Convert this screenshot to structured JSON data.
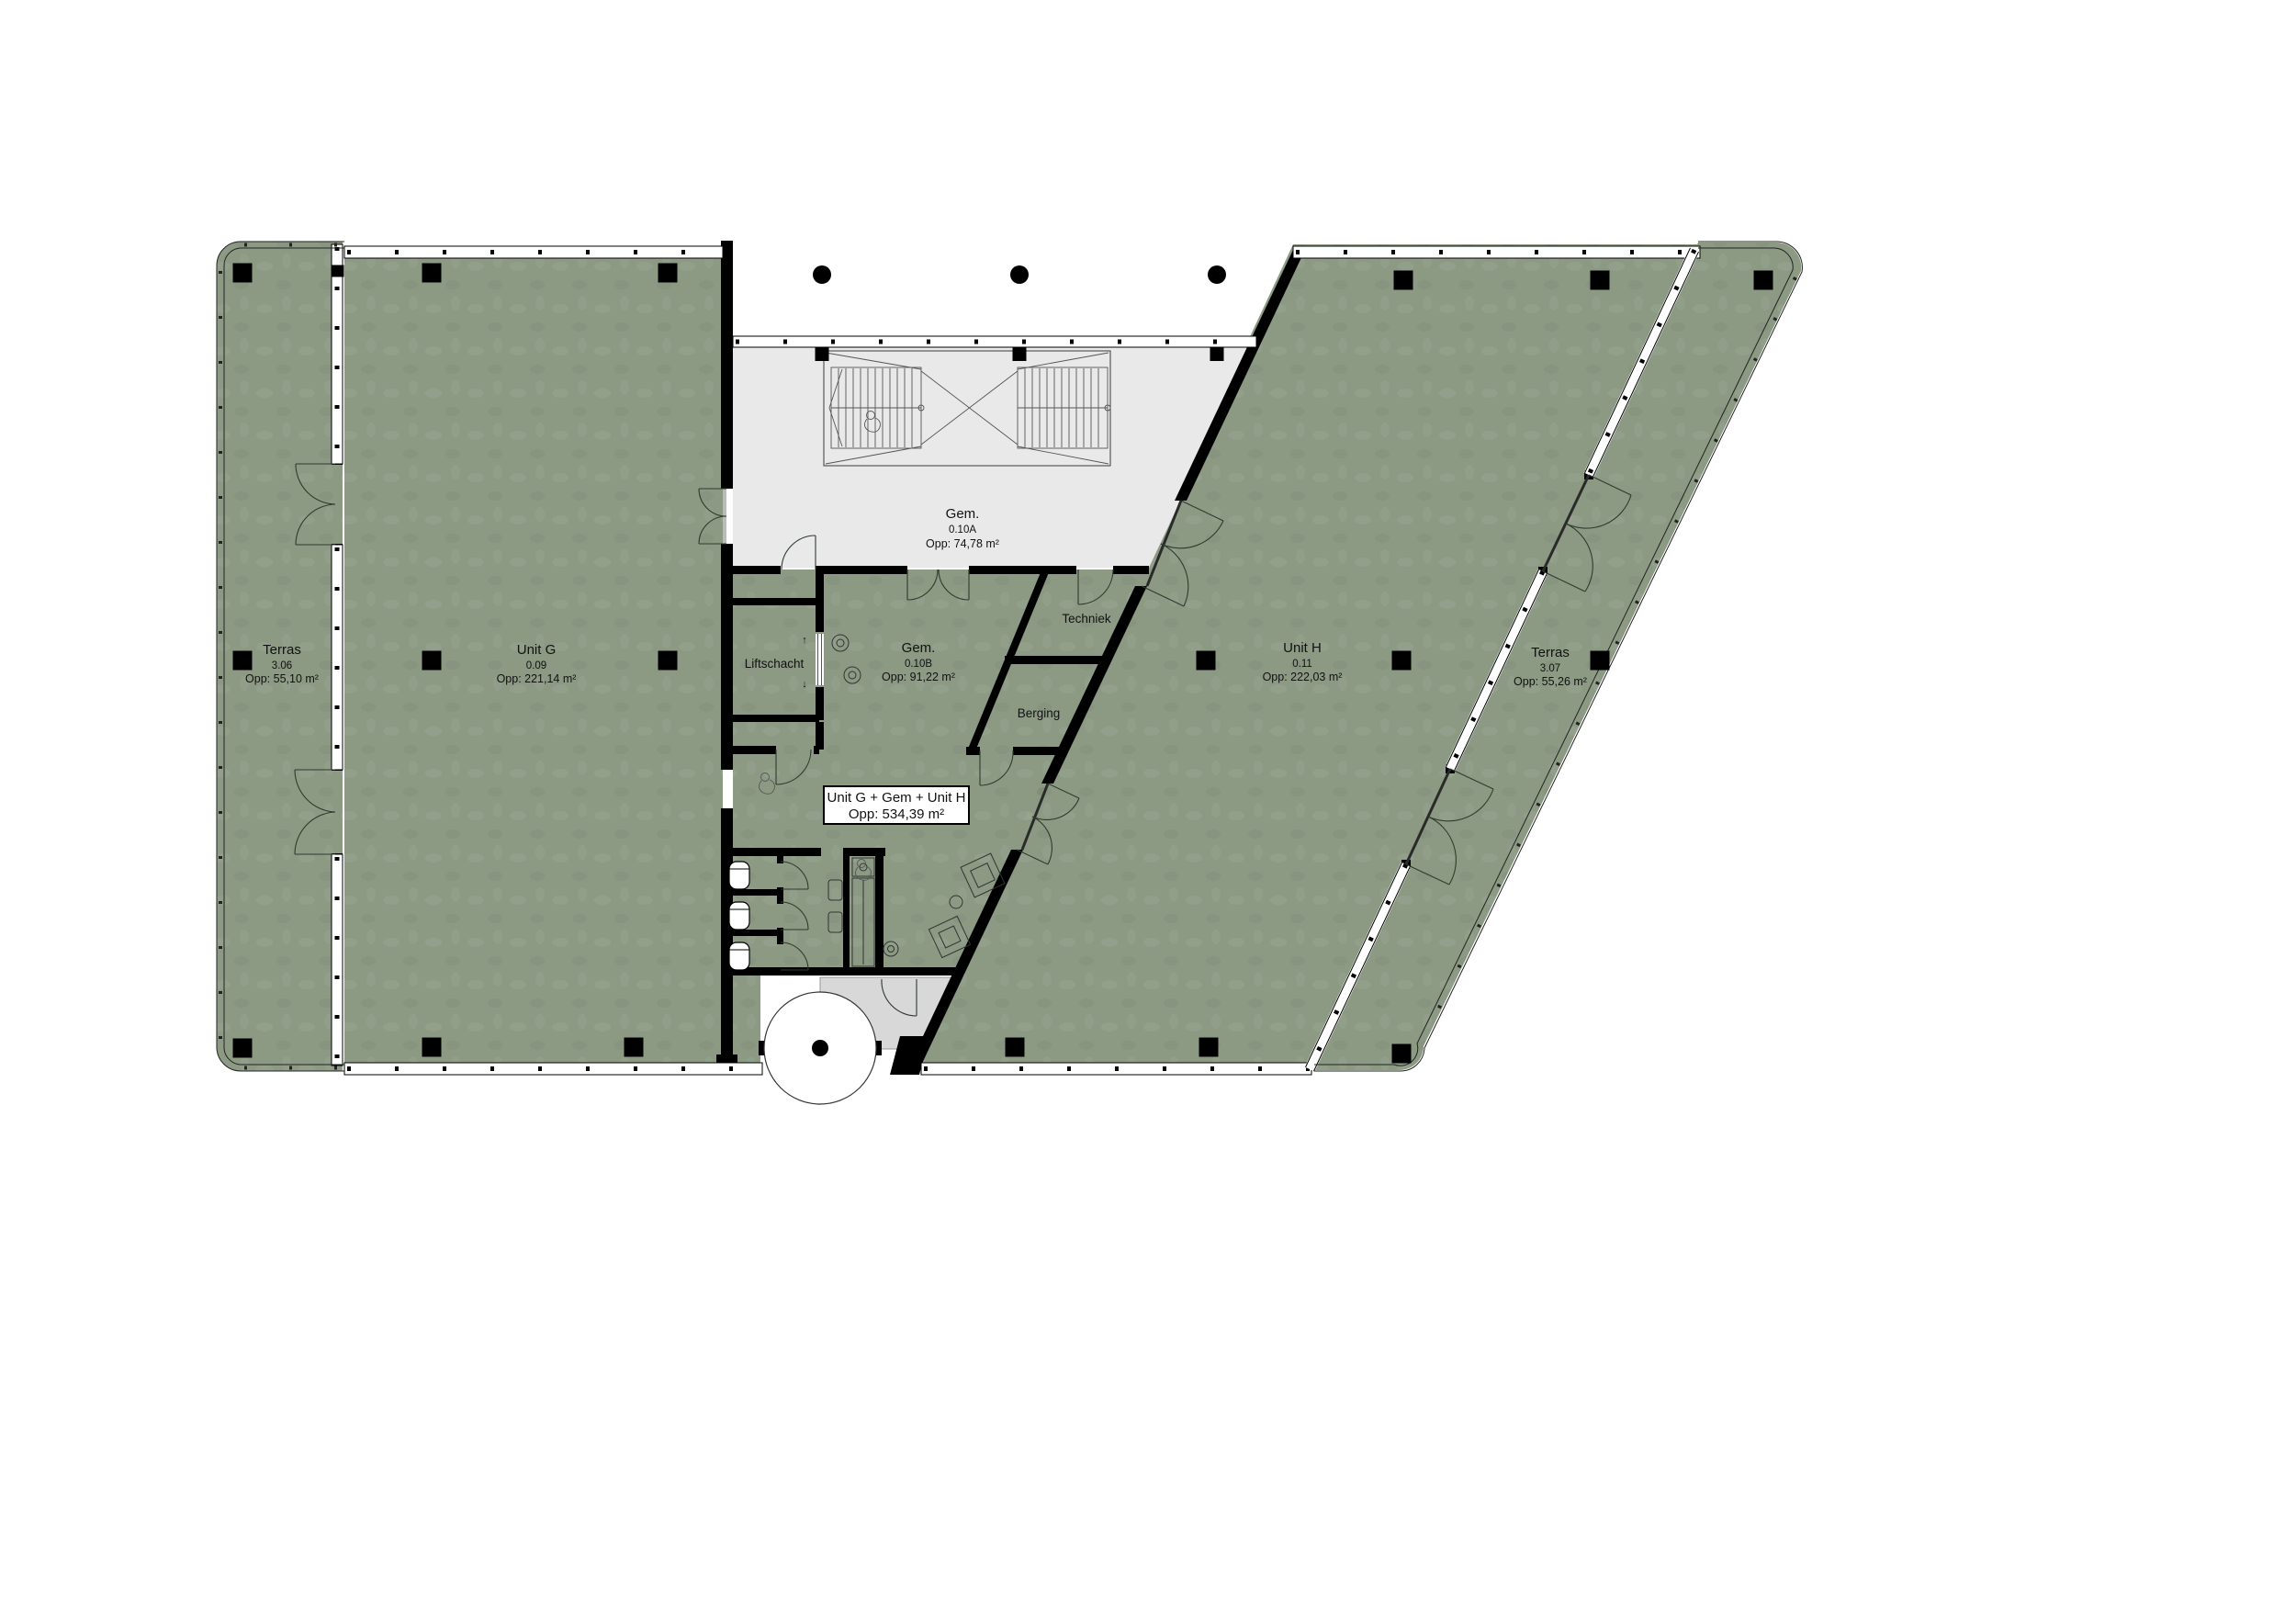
{
  "document": {
    "type": "architectural floor plan",
    "language": "nl"
  },
  "colors": {
    "unit_fill": "#8c9a84",
    "common_fill": "#e9e9e9",
    "vestibule_fill": "#d8d8d8",
    "wall": "#000000",
    "line": "#222222",
    "label_box_bg": "#ffffff"
  },
  "rooms": {
    "terras_306": {
      "name": "Terras",
      "number": "3.06",
      "area": "Opp: 55,10 m²"
    },
    "unit_g": {
      "name": "Unit G",
      "number": "0.09",
      "area": "Opp: 221,14 m²"
    },
    "gem_010a": {
      "name": "Gem.",
      "number": "0.10A",
      "area": "Opp: 74,78 m²"
    },
    "gem_010b": {
      "name": "Gem.",
      "number": "0.10B",
      "area": "Opp: 91,22 m²"
    },
    "liftschacht": {
      "name": "Liftschacht"
    },
    "techniek": {
      "name": "Techniek"
    },
    "berging": {
      "name": "Berging"
    },
    "unit_h": {
      "name": "Unit H",
      "number": "0.11",
      "area": "Opp: 222,03 m²"
    },
    "terras_307": {
      "name": "Terras",
      "number": "3.07",
      "area": "Opp: 55,26 m²"
    }
  },
  "summary_box": {
    "line1": "Unit G + Gem + Unit H",
    "line2": "Opp: 534,39 m²"
  },
  "lift": {
    "arrow_up": "↑",
    "arrow_down": "↓"
  }
}
